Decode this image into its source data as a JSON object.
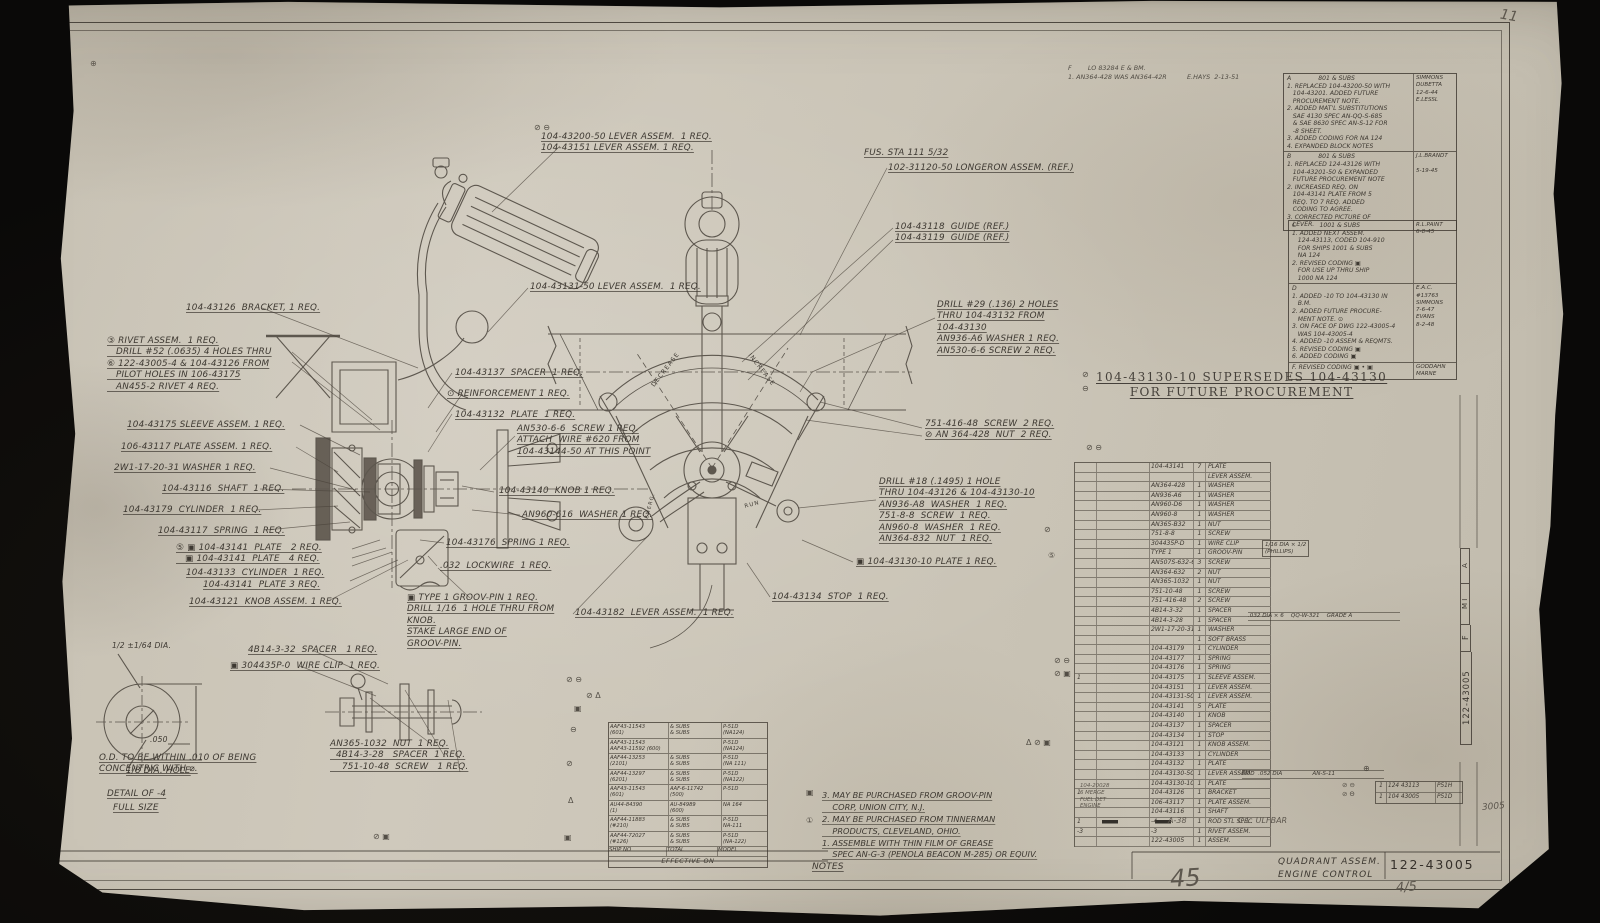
{
  "sheet": {
    "page_number_large": "45",
    "page_number_small": "4/5",
    "pencil_top_right": "11",
    "pencil_right": "3005"
  },
  "title_block": {
    "title": "QUADRANT ASSEM.\nENGINE CONTROL",
    "drawing_number": "122-43005"
  },
  "edge_strip": {
    "letter_a": "A",
    "letters_mi": "M I",
    "letter_f": "F",
    "number": "122-43005"
  },
  "stamp_top": {
    "text": "F        LO 83284 E & BM.\n1. AN364-428 WAS AN364-42R          E.HAYS  2-13-51"
  },
  "supersede": {
    "text": "104-43130-10 SUPERSEDES 104-43130\nFOR FUTURE PROCUREMENT"
  },
  "labels": {
    "fus_sta": "FUS. STA 111 5/32",
    "decrease": "DECREASE",
    "increase": "INCREASE",
    "run": "RUN",
    "emerg": "EMERG."
  },
  "callouts": {
    "lever_top": "104-43200-50 LEVER ASSEM.  1 REQ.\n104-43151 LEVER ASSEM. 1 REQ.",
    "longeron": "102-31120-50 LONGERON ASSEM. (REF.)",
    "guides": "104-43118  GUIDE (REF.)\n104-43119  GUIDE (REF.)",
    "lever131": "104-43131-50 LEVER ASSEM.  1 REQ.",
    "bracket": "104-43126  BRACKET, 1 REQ.",
    "rivet": "③ RIVET ASSEM.  1 REQ.\n   DRILL #52 (.0635) 4 HOLES THRU\n⑥ 122-43005-4 & 104-43126 FROM\n   PILOT HOLES IN 106-43175\n   AN455-2 RIVET 4 REQ.",
    "drill29": "DRILL #29 (.136) 2 HOLES\nTHRU 104-43132 FROM\n104-43130\nAN936-A6 WASHER 1 REQ.\nAN530-6-6 SCREW 2 REQ.",
    "sleeve": "104-43175 SLEEVE ASSEM. 1 REQ.",
    "plate_assem": "106-43117 PLATE ASSEM. 1 REQ.",
    "washer_2w1": "2W1-17-20-31 WASHER 1 REQ.",
    "shaft": "104-43116  SHAFT  1 REQ.",
    "cyl179": "104-43179  CYLINDER  1 REQ.",
    "spring117": "104-43117  SPRING  1 REQ.",
    "plates24": "⑤ ▣ 104-43141  PLATE   2 REQ.\n   ▣ 104-43141  PLATE   4 REQ.",
    "cyl133": "104-43133  CYLINDER  1 REQ.",
    "plate3": "104-43141  PLATE 3 REQ.",
    "knob_assem": "104-43121  KNOB ASSEM. 1 REQ.",
    "spacer137": "104-43137  SPACER  1 REQ.",
    "reinforcement": "⊙ REINFORCEMENT 1 REQ.",
    "plate132": "104-43132  PLATE  1 REQ.",
    "an530": "AN530-6-6  SCREW 1 REQ.\nATTACH  WIRE #620 FROM\n104-43144-50 AT THIS POINT",
    "knob140": "104-43140  KNOB 1 REQ.",
    "washer960": "AN960-616  WASHER 1 REQ.",
    "spring176": "104-43176  SPRING 1 REQ.",
    "lockwire": ".032  LOCKWIRE  1 REQ.",
    "groovpin": "▣ TYPE 1 GROOV-PIN 1 REQ.\nDRILL 1/16  1 HOLE THRU FROM\nKNOB.\nSTAKE LARGE END OF\nGROOV-PIN.",
    "lever182": "104-43182  LEVER ASSEM.  1 REQ.",
    "stop": "104-43134  STOP  1 REQ.",
    "screw751": "751-416-48  SCREW  2 REQ.\n⊘ AN 364-428  NUT  2 REQ.",
    "drill18": "DRILL #18 (.1495) 1 HOLE\nTHRU 104-43126 & 104-43130-10\nAN936-A8  WASHER  1 REQ.\n751-8-8  SCREW  1 REQ.\nAN960-8  WASHER  1 REQ.\nAN364-832  NUT  1 REQ.",
    "plate130": "▣ 104-43130-10 PLATE 1 REQ.",
    "spacer432": "4B14-3-32  SPACER   1 REQ.",
    "wireclip": "▣ 304435P-0  WIRE CLIP  1 REQ.",
    "bolt_group": "AN365-1032  NUT  1 REQ.\n  4B14-3-28   SPACER  1 REQ.\n    751-10-48  SCREW   1 REQ."
  },
  "detail": {
    "half_dia": "1/2 ±1/64 DIA.",
    "dim050": ".050",
    "hole": "1/8 DIA. HOLE",
    "od_note": "O.D. TO BE WITHIN .010 OF BEING\nCONCENTRIC WITH ⌀.",
    "title": "DETAIL OF -4",
    "scale": "FULL SIZE"
  },
  "revisions1": {
    "a_text": "A              801 & SUBS\n1. REPLACED 104-43200-50 WITH\n   104-43201. ADDED FUTURE\n   PROCUREMENT NOTE.\n2. ADDED MAT'L SUBSTITUTIONS\n   SAE 4130 SPEC AN-QQ-S-685\n   & SAE 8630 SPEC AN-S-12 FOR\n   -8 SHEET.\n3. ADDED CODING FOR NA 124\n4. EXPANDED BLOCK NOTES",
    "a_sig": "SIMMONS\nDUBETTA\n12-6-44\nE.LESSL",
    "b_text": "B              801 & SUBS\n1. REPLACED 124-43126 WITH\n   104-43201-50 & EXPANDED\n   FUTURE PROCUREMENT NOTE\n2. INCREASED REQ. ON\n   104-43141 PLATE FROM 5\n   REQ. TO 7 REQ. ADDED\n   CODING TO AGREE.\n3. CORRECTED PICTURE OF\n   LEVER.",
    "b_sig": "J.L.BRANDT\n\n5-19-45"
  },
  "revisions2": {
    "c_text": "C            1001 & SUBS\n1. ADDED NEXT ASSEM.\n   124-43113, CODED 104-910\n   FOR SHIPS 1001 & SUBS\n   NA 124\n2. REVISED CODING ▣\n   FOR USE UP THRU SHIP\n   1000 NA 124",
    "c_sig": "R.L.PAINT\n6-8-45",
    "d_text": "D\n1. ADDED -10 TO 104-43130 IN\n   B.M.\n2. ADDED FUTURE PROCURE-\n   MENT NOTE. ⊙\n3. ON FACE OF DWG 122-43005-4\n   WAS 104-43005-4\n4. ADDED -10 ASSEM & REQMTS.\n5. REVISED CODING ▣\n6. ADDED CODING ▣",
    "d_sig": "E.A.C.\n#13763\nSIMMONS\n7-6-47\nEVANS\n8-2-48",
    "e_text": "F. REVISED CODING ▣ • ▣",
    "e_sig": "GODDAHN\nMARNE"
  },
  "parts": {
    "rows": [
      {
        "m": "",
        "pn": "104-43141",
        "qty": "7",
        "desc": "PLATE"
      },
      {
        "m": "",
        "pn": "",
        "qty": "",
        "desc": "LEVER ASSEM."
      },
      {
        "m": "",
        "pn": "AN364-428",
        "qty": "1",
        "desc": "WASHER"
      },
      {
        "m": "",
        "pn": "AN936-A6",
        "qty": "1",
        "desc": "WASHER"
      },
      {
        "m": "",
        "pn": "AN960-D6",
        "qty": "1",
        "desc": "WASHER"
      },
      {
        "m": "",
        "pn": "AN960-8",
        "qty": "1",
        "desc": "WASHER"
      },
      {
        "m": "",
        "pn": "AN365-B32",
        "qty": "1",
        "desc": "NUT"
      },
      {
        "m": "",
        "pn": "751-8-8",
        "qty": "1",
        "desc": "SCREW"
      },
      {
        "m": "",
        "pn": "304435P-D",
        "qty": "1",
        "desc": "WIRE CLIP"
      },
      {
        "m": "",
        "pn": "TYPE 1",
        "qty": "1",
        "desc": "GROOV-PIN"
      },
      {
        "m": "",
        "pn": "AN507S-632-6",
        "qty": "3",
        "desc": "SCREW"
      },
      {
        "m": "",
        "pn": "AN364-632",
        "qty": "2",
        "desc": "NUT"
      },
      {
        "m": "",
        "pn": "AN365-1032",
        "qty": "1",
        "desc": "NUT"
      },
      {
        "m": "",
        "pn": "751-10-48",
        "qty": "1",
        "desc": "SCREW"
      },
      {
        "m": "",
        "pn": "751-416-48",
        "qty": "2",
        "desc": "SCREW"
      },
      {
        "m": "",
        "pn": "4B14-3-32",
        "qty": "1",
        "desc": "SPACER"
      },
      {
        "m": "",
        "pn": "4B14-3-28",
        "qty": "1",
        "desc": "SPACER"
      },
      {
        "m": "",
        "pn": "2W1-17-20-31",
        "qty": "1",
        "desc": "WASHER"
      },
      {
        "m": "",
        "pn": "",
        "qty": "1",
        "desc": "SOFT BRASS"
      },
      {
        "m": "",
        "pn": "104-43179",
        "qty": "1",
        "desc": "CYLINDER"
      },
      {
        "m": "",
        "pn": "104-43177",
        "qty": "1",
        "desc": "SPRING"
      },
      {
        "m": "",
        "pn": "104-43176",
        "qty": "1",
        "desc": "SPRING"
      },
      {
        "m": "1",
        "pn": "104-43175",
        "qty": "1",
        "desc": "SLEEVE ASSEM."
      },
      {
        "m": "",
        "pn": "104-43151",
        "qty": "1",
        "desc": "LEVER ASSEM."
      },
      {
        "m": "",
        "pn": "104-43131-50",
        "qty": "1",
        "desc": "LEVER ASSEM."
      },
      {
        "m": "",
        "pn": "104-43141",
        "qty": "5",
        "desc": "PLATE"
      },
      {
        "m": "",
        "pn": "104-43140",
        "qty": "1",
        "desc": "KNOB"
      },
      {
        "m": "",
        "pn": "104-43137",
        "qty": "1",
        "desc": "SPACER"
      },
      {
        "m": "",
        "pn": "104-43134",
        "qty": "1",
        "desc": "STOP"
      },
      {
        "m": "",
        "pn": "104-43121",
        "qty": "1",
        "desc": "KNOB ASSEM."
      },
      {
        "m": "",
        "pn": "104-43133",
        "qty": "1",
        "desc": "CYLINDER"
      },
      {
        "m": "",
        "pn": "104-43132",
        "qty": "1",
        "desc": "PLATE"
      },
      {
        "m": "",
        "pn": "104-43130-50",
        "qty": "1",
        "desc": "LEVER ASSEM."
      },
      {
        "m": "",
        "pn": "104-43130-10",
        "qty": "1",
        "desc": "PLATE"
      },
      {
        "m": "1",
        "pn": "104-43126",
        "qty": "1",
        "desc": "BRACKET"
      },
      {
        "m": "",
        "pn": "106-43117",
        "qty": "1",
        "desc": "PLATE ASSEM."
      },
      {
        "m": "",
        "pn": "104-43116",
        "qty": "1",
        "desc": "SHAFT"
      },
      {
        "m": "1",
        "pn": "-4",
        "qty": "1",
        "desc": "ROD STL SPEC"
      },
      {
        "m": "-3",
        "pn": "-3",
        "qty": "1",
        "desc": "RIVET ASSEM."
      },
      {
        "m": "",
        "pn": "122-43005",
        "qty": "1",
        "desc": "ASSEM."
      }
    ],
    "ext_pin": "1/16 DIA × 1/2\n(PHILLIPS)",
    "ext_brass": ".032 DIA × 6    QQ-W-321    GRADE A",
    "ext_rod": "ROD  .052 DIA                 AN-S-11",
    "bottom_left": "A-38",
    "inspector": "C.L. ULFBAR",
    "pencil_block": "104-20028\n6 MERGE\nFUEL DET\nENGINE"
  },
  "next_assy": {
    "rows": [
      {
        "q": "1",
        "pn": "124 43113",
        "model": "P51H"
      },
      {
        "q": "1",
        "pn": "104 43005",
        "model": "P51D"
      }
    ]
  },
  "effectivity": {
    "rows": [
      {
        "c1": "AAF43-11543\n(601)",
        "c2": "& SUBS\n& SUBS",
        "c3": "P-51D\n(NA124)"
      },
      {
        "c1": "AAF43-11543\nAAF43-11592 (600)",
        "c2": "",
        "c3": "P-51D\n(NA124)"
      },
      {
        "c1": "AAF44-13253\n(2101)",
        "c2": "& SUBS\n& SUBS",
        "c3": "P-51D\n(NA 111)"
      },
      {
        "c1": "AAF44-13297\n(6201)",
        "c2": "& SUBS\n& SUBS",
        "c3": "P-51D\n(NA122)"
      },
      {
        "c1": "AAF43-11543\n(601)",
        "c2": "AAF-6-11742\n(500)",
        "c3": "P-51D"
      },
      {
        "c1": "AU44-84390\n(1)",
        "c2": "AU-84989\n(600)",
        "c3": "NA 164"
      },
      {
        "c1": "AAF44-11883\n(#210)",
        "c2": "& SUBS\n& SUBS",
        "c3": "P-51D\nNA-111"
      },
      {
        "c1": "AAF44-72027\n(#126)",
        "c2": "& SUBS\n& SUBS",
        "c3": "P-51D\n(NA-122)"
      }
    ],
    "footer": {
      "c1": "SHIP NO",
      "c2": "TOTAL",
      "c3": "MODEL"
    },
    "title": "EFFECTIVE ON"
  },
  "notes": {
    "body": "3. MAY BE PURCHASED FROM GROOV-PIN\n    CORP, UNION CITY, N.J.\n2. MAY BE PURCHASED FROM TINNERMAN\n    PRODUCTS, CLEVELAND, OHIO.\n1. ASSEMBLE WITH THIN FILM OF GREASE\n    SPEC AN-G-3 (PENOLA BEACON M-285) OR EQUIV.",
    "title": "NOTES"
  },
  "marks": {
    "m1": "⊘ ⊖",
    "m2": "⊕",
    "m3": "⊘ ⊖",
    "m4": "⊘ Δ",
    "m5": "⊘ ⊖",
    "m6": "⊘",
    "m7": "⑤",
    "m8": "⊘ ⊖",
    "m9": "⊘ ▣",
    "m10": "Δ ⊘ ▣",
    "m11": "▣",
    "m12": "①",
    "m13": "⊘ ⊖",
    "m14": "⊘ Θ",
    "m15": "⊕",
    "m16": "▣",
    "m17": "⊖",
    "m18": "⊘",
    "m19": "Δ",
    "m20": "▣",
    "m21": "⊘ ▣",
    "m22": "⊘",
    "m23": "⊖"
  }
}
